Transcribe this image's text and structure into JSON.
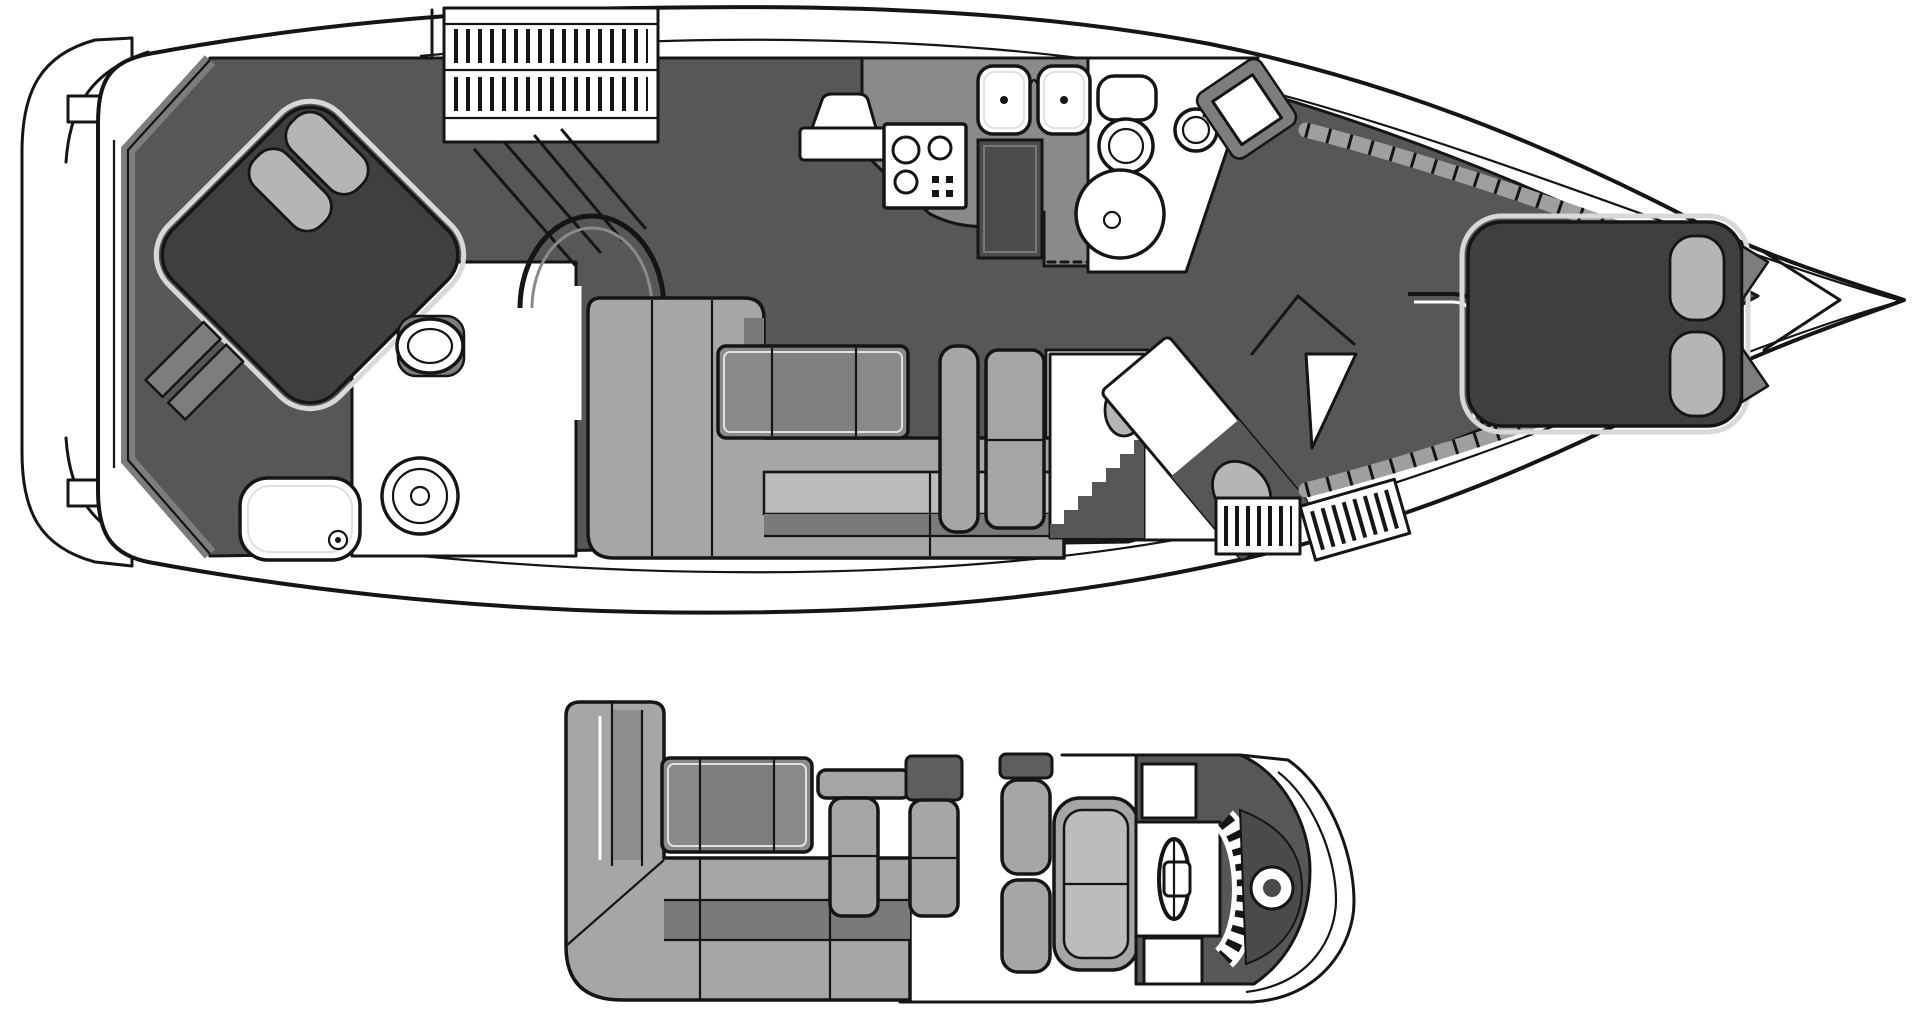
{
  "palette": {
    "bg": "#ffffff",
    "white": "#ffffff",
    "ink": "#151515",
    "floor": "#575757",
    "wall": "#7d7d7d",
    "counter": "#8a8a8a",
    "sofa": "#a6a6a6",
    "sofa_light": "#bcbcbc",
    "sofa_shadow": "#7a7a7a",
    "bed": "#3f3f3f",
    "pillow": "#b5b5b5",
    "table": "#8a8a8a",
    "appliance": "#4c4c4c",
    "steel": "#9f9f9f",
    "pod": "#4a4a4a"
  },
  "figure": {
    "type": "yacht-floorplan-diagram",
    "views": 2
  },
  "plans": {
    "main_deck": {
      "label": "Main deck and accommodations plan",
      "features": [
        {
          "label": "Swim platform"
        },
        {
          "label": "Cockpit"
        },
        {
          "label": "Aft master stateroom"
        },
        {
          "label": "Island berth with pillows"
        },
        {
          "label": "Bathtub"
        },
        {
          "label": "Aft head with toilet and sink"
        },
        {
          "label": "Companionway stairs"
        },
        {
          "label": "Salon L-shaped sofa"
        },
        {
          "label": "Cocktail table"
        },
        {
          "label": "Armchair"
        },
        {
          "label": "Galley counter"
        },
        {
          "label": "Double sink"
        },
        {
          "label": "Cooktop"
        },
        {
          "label": "Refrigerator"
        },
        {
          "label": "Forward head"
        },
        {
          "label": "Shower"
        },
        {
          "label": "Vanity"
        },
        {
          "label": "Guest stateroom with criss-cross berths"
        },
        {
          "label": "Steps"
        },
        {
          "label": "Forward stateroom V-berth"
        },
        {
          "label": "Hull side shelves"
        },
        {
          "label": "Bow deck"
        }
      ]
    },
    "flybridge": {
      "label": "Flybridge plan",
      "features": [
        {
          "label": "L-shaped settee"
        },
        {
          "label": "Flybridge table"
        },
        {
          "label": "Companion bench"
        },
        {
          "label": "Back-to-back seat"
        },
        {
          "label": "Helm bench seat"
        },
        {
          "label": "Helm console"
        },
        {
          "label": "Steering wheel"
        },
        {
          "label": "Instrument panel"
        },
        {
          "label": "Console pod"
        }
      ]
    }
  }
}
